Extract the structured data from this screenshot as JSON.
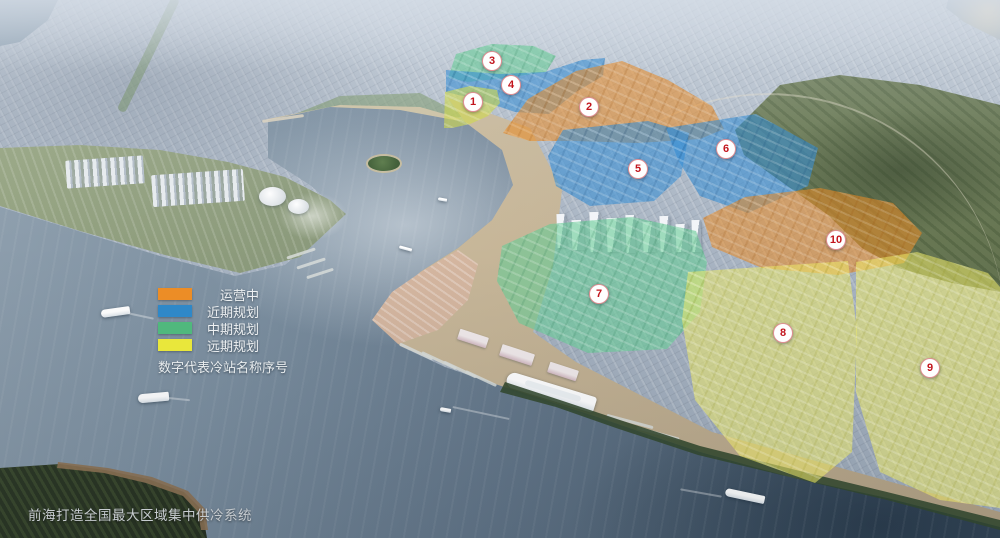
{
  "caption": "前海打造全国最大区域集中供冷系统",
  "legend": {
    "items": [
      {
        "id": "operating",
        "label": "运营中",
        "color": "#EC8D26"
      },
      {
        "id": "near-term",
        "label": "近期规划",
        "color": "#2F88C8"
      },
      {
        "id": "mid-term",
        "label": "中期规划",
        "color": "#50B87D"
      },
      {
        "id": "long-term",
        "label": "远期规划",
        "color": "#E9E73B"
      }
    ],
    "note": "数字代表冷站名称序号"
  },
  "marker_text_color": "#C2151D",
  "markers": [
    {
      "num": "1",
      "x": 472,
      "y": 101,
      "category": "long-term"
    },
    {
      "num": "2",
      "x": 588,
      "y": 106,
      "category": "operating"
    },
    {
      "num": "3",
      "x": 491,
      "y": 60,
      "category": "mid-term"
    },
    {
      "num": "4",
      "x": 510,
      "y": 84,
      "category": "near-term"
    },
    {
      "num": "5",
      "x": 637,
      "y": 168,
      "category": "near-term"
    },
    {
      "num": "6",
      "x": 725,
      "y": 148,
      "category": "near-term"
    },
    {
      "num": "7",
      "x": 598,
      "y": 293,
      "category": "mid-term"
    },
    {
      "num": "8",
      "x": 782,
      "y": 332,
      "category": "long-term"
    },
    {
      "num": "9",
      "x": 929,
      "y": 367,
      "category": "long-term"
    },
    {
      "num": "10",
      "x": 835,
      "y": 239,
      "category": "operating"
    }
  ]
}
